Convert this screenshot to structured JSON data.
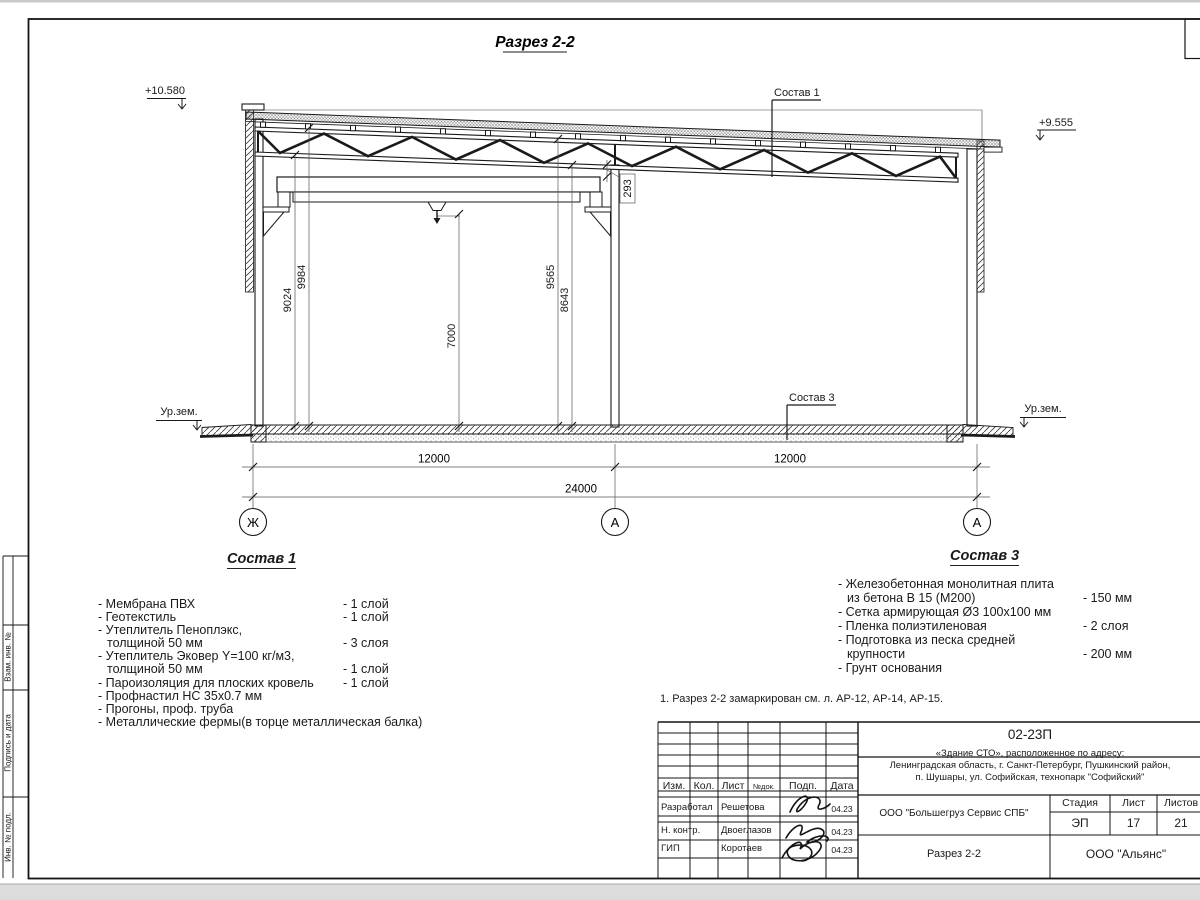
{
  "frame": {
    "stamp_vzam": "Взам. инв. №",
    "stamp_podpis": "Подпись и дата",
    "stamp_inv": "Инв. № подл."
  },
  "drawing": {
    "title": "Разрез 2-2",
    "elev_left": "+10.580",
    "elev_right": "+9.555",
    "ground_left": "Ур.зем.",
    "ground_right": "Ур.зем.",
    "leader_sostav1": "Состав 1",
    "leader_sostav3": "Состав 3",
    "dim_9024": "9024",
    "dim_9984": "9984",
    "dim_7000": "7000",
    "dim_9565": "9565",
    "dim_8643": "8643",
    "dim_293": "293",
    "dim_bay_left": "12000",
    "dim_bay_right": "12000",
    "dim_total": "24000",
    "axis_left": "Ж",
    "axis_mid": "А",
    "axis_right": "А"
  },
  "sostav1": {
    "heading": "Состав 1",
    "items": [
      {
        "t": "- Мембрана ПВХ",
        "q": "- 1 слой"
      },
      {
        "t": "- Геотекстиль",
        "q": "- 1 слой"
      },
      {
        "t": "- Утеплитель Пеноплэкс,",
        "q": ""
      },
      {
        "t": "толщиной 50 мм",
        "q": "- 3 слоя"
      },
      {
        "t": "- Утеплитель Эковер Y=100 кг/м3,",
        "q": ""
      },
      {
        "t": "толщиной 50 мм",
        "q": "- 1 слой"
      },
      {
        "t": "- Пароизоляция для плоских кровель",
        "q": "- 1 слой"
      },
      {
        "t": "- Профнастил НС 35х0.7 мм",
        "q": ""
      },
      {
        "t": "- Прогоны, проф. труба",
        "q": ""
      },
      {
        "t": "- Металлические фермы(в торце металлическая балка)",
        "q": ""
      }
    ]
  },
  "sostav3": {
    "heading": "Состав 3",
    "items": [
      {
        "t": "- Железобетонная  монолитная плита",
        "q": ""
      },
      {
        "t": "из бетона В 15 (М200)",
        "q": "- 150 мм"
      },
      {
        "t": "- Сетка армирующая Ø3 100х100 мм",
        "q": ""
      },
      {
        "t": "- Пленка полиэтиленовая",
        "q": "- 2 слоя"
      },
      {
        "t": "- Подготовка из песка средней",
        "q": ""
      },
      {
        "t": "крупности",
        "q": "- 200 мм"
      },
      {
        "t": "- Грунт основания",
        "q": ""
      }
    ]
  },
  "note": "1. Разрез 2-2 замаркирован см. л. АР-12, АР-14, АР-15.",
  "titleblock": {
    "code": "02-23П",
    "object_line1": "«Здание СТО», расположенное по адресу:",
    "object_line2": "Ленинградская область, г. Санкт-Петербург, Пушкинский район,",
    "object_line3": "п. Шушары, ул. Софийская, технопарк \"Софийский\"",
    "col_izm": "Изм.",
    "col_kol": "Кол.",
    "col_list": "Лист",
    "col_ndok": "№док.",
    "col_podp": "Подп.",
    "col_data": "Дата",
    "row1_role": "Разработал",
    "row1_name": "Решетова",
    "row1_date": "04.23",
    "row2_role": "Н. контр.",
    "row2_name": "Двоеглазов",
    "row2_date": "04.23",
    "row3_role": "ГИП",
    "row3_name": "Коротаев",
    "row3_date": "04.23",
    "org": "ООО \"Большегруз Сервис СПБ\"",
    "stage_label": "Стадия",
    "sheet_label": "Лист",
    "sheets_label": "Листов",
    "stage": "ЭП",
    "sheet": "17",
    "sheets": "21",
    "doc_name": "Разрез 2-2",
    "company": "ООО \"Альянс\""
  }
}
